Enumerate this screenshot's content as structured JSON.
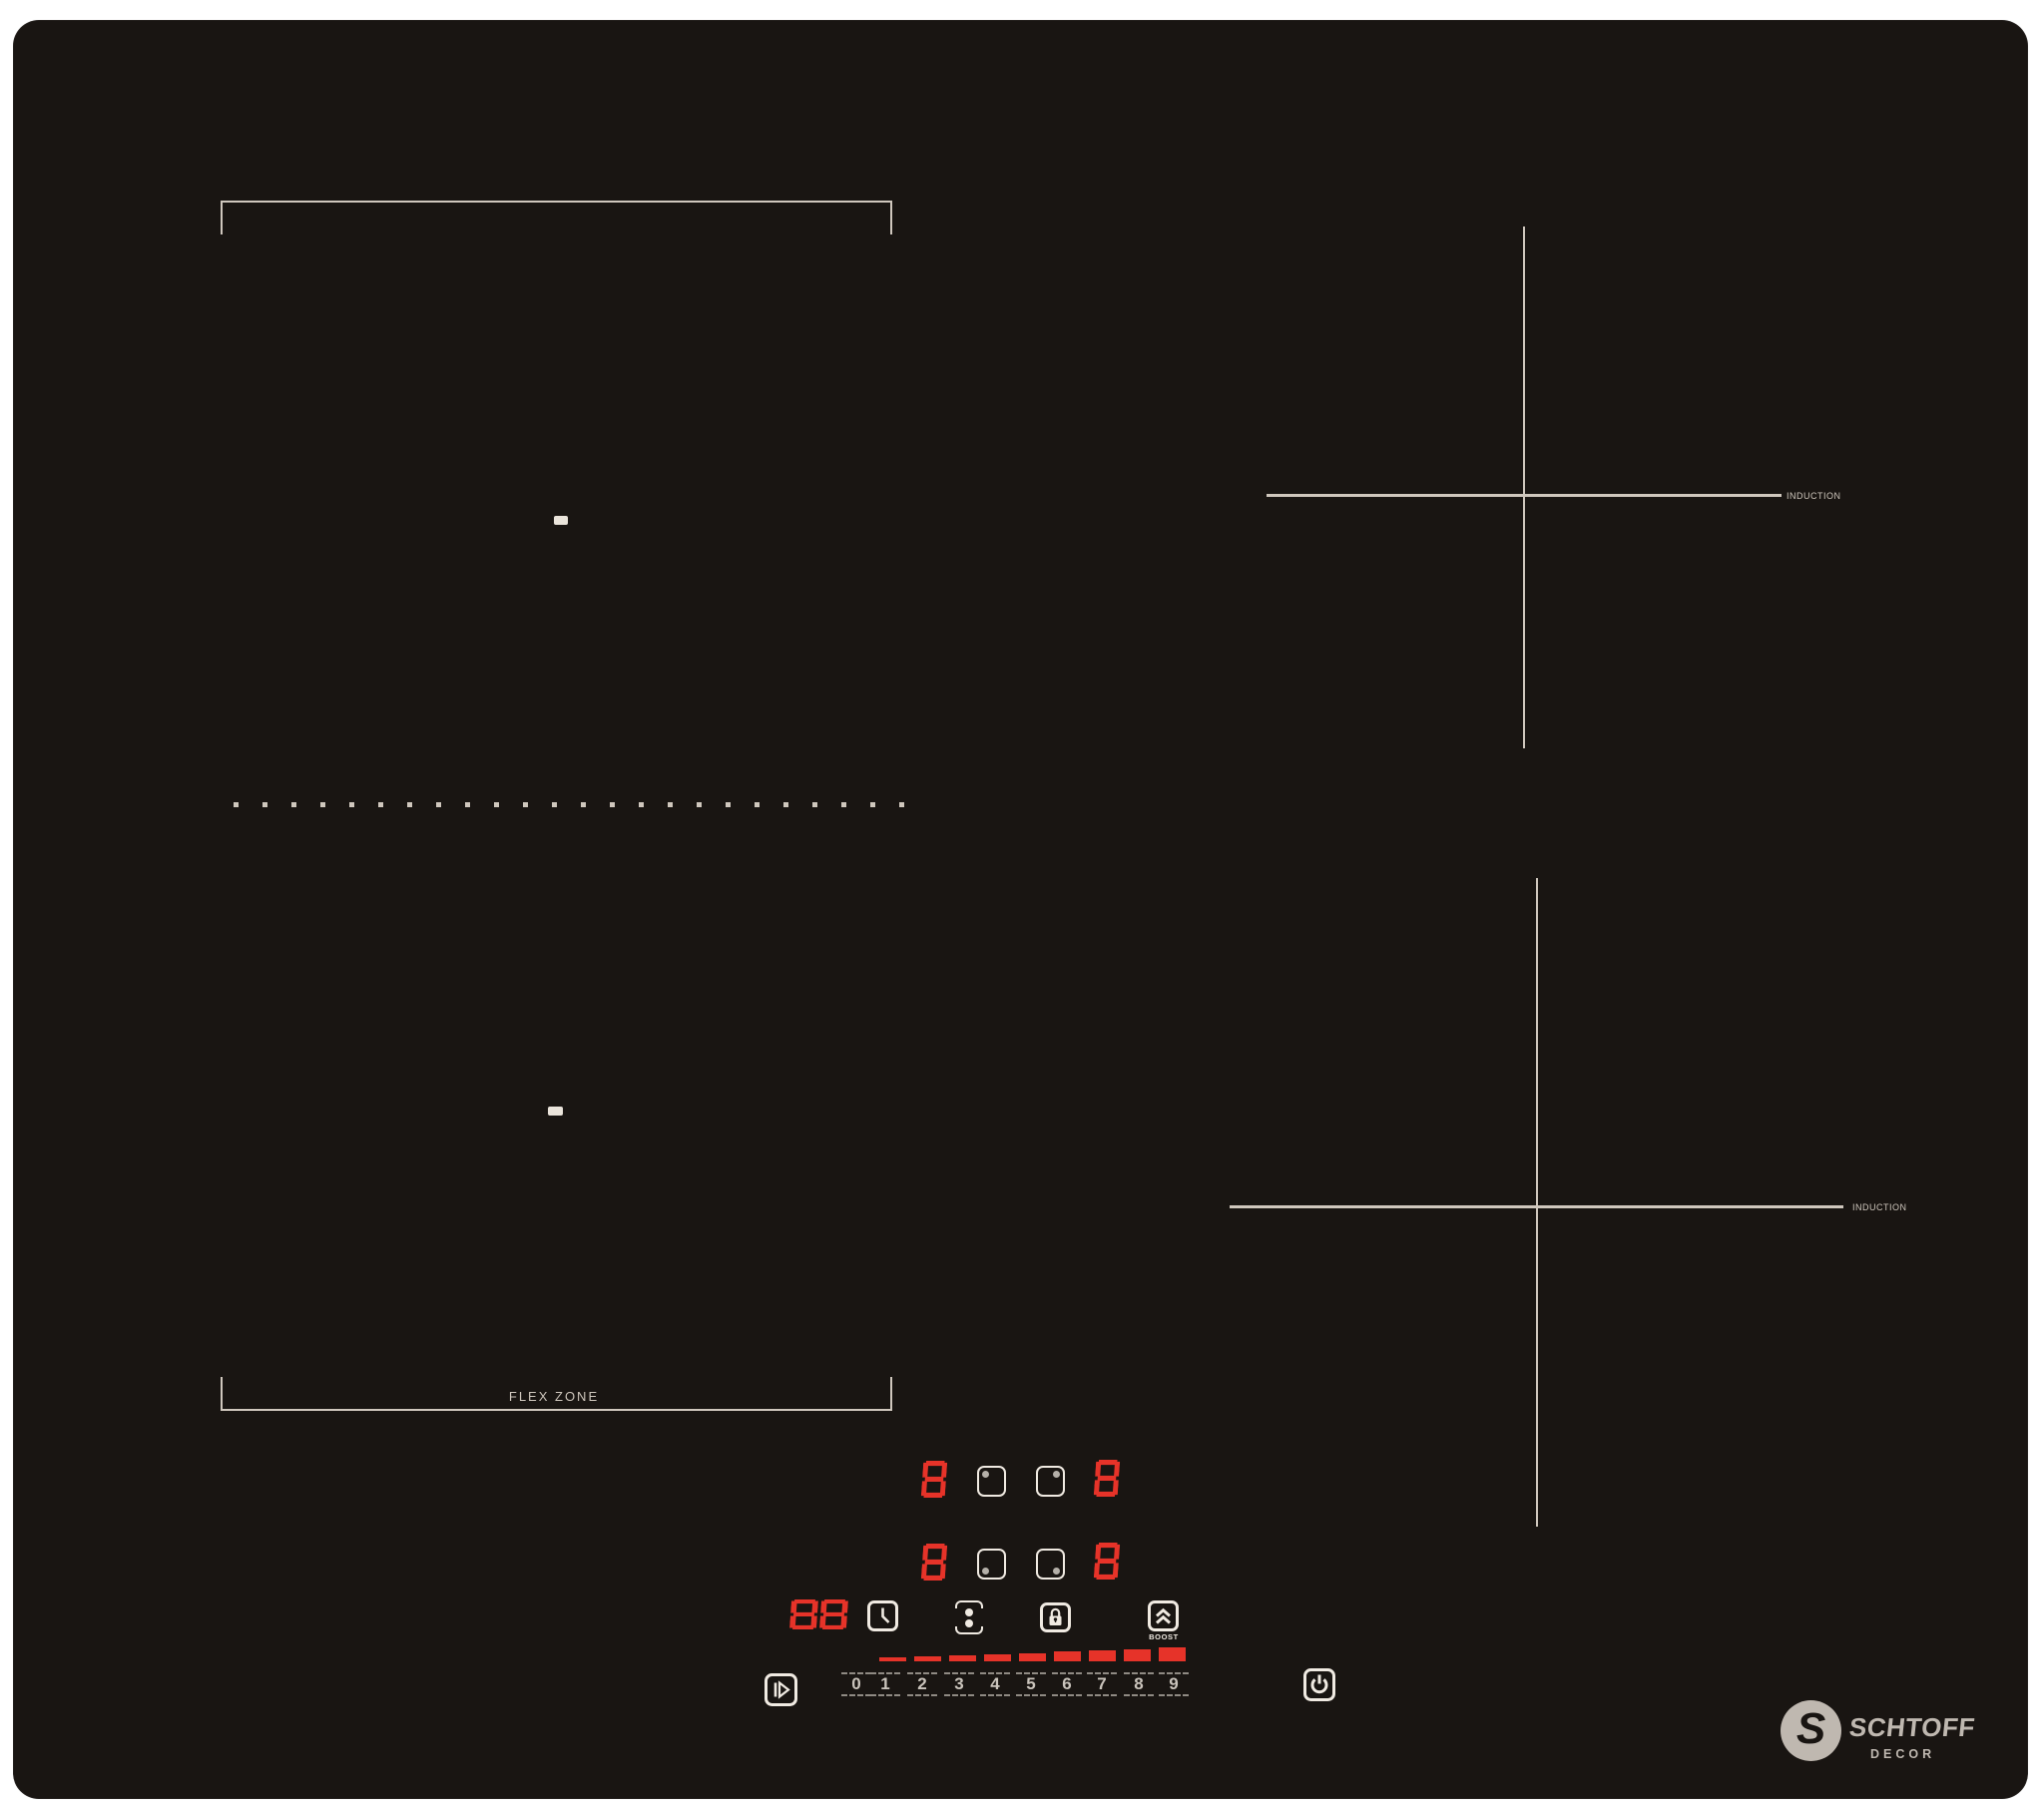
{
  "brand": {
    "monogram": "S",
    "name": "SCHTOFF",
    "subtitle": "DECOR"
  },
  "surface": {
    "flex_zone_label": "FLEX ZONE",
    "rear_right_zone_label": "INDUCTION",
    "front_right_zone_label": "INDUCTION"
  },
  "displays": {
    "rear_left_power": "8",
    "rear_right_power": "8",
    "front_left_power": "8",
    "front_right_power": "8",
    "timer": "88"
  },
  "controls": {
    "boost_label": "BOOST",
    "power_levels": [
      "0",
      "1",
      "2",
      "3",
      "4",
      "5",
      "6",
      "7",
      "8",
      "9"
    ]
  },
  "colors": {
    "page_background": "#ffffff",
    "glass_black": "#191512",
    "marking_beige": "#cfc7bd",
    "key_white": "#f0eae2",
    "segment_red": "#e63329",
    "number_gray": "#cac4bc",
    "key_dot_gray": "#b5b0a9",
    "logo_gray": "#bfb8b0"
  }
}
